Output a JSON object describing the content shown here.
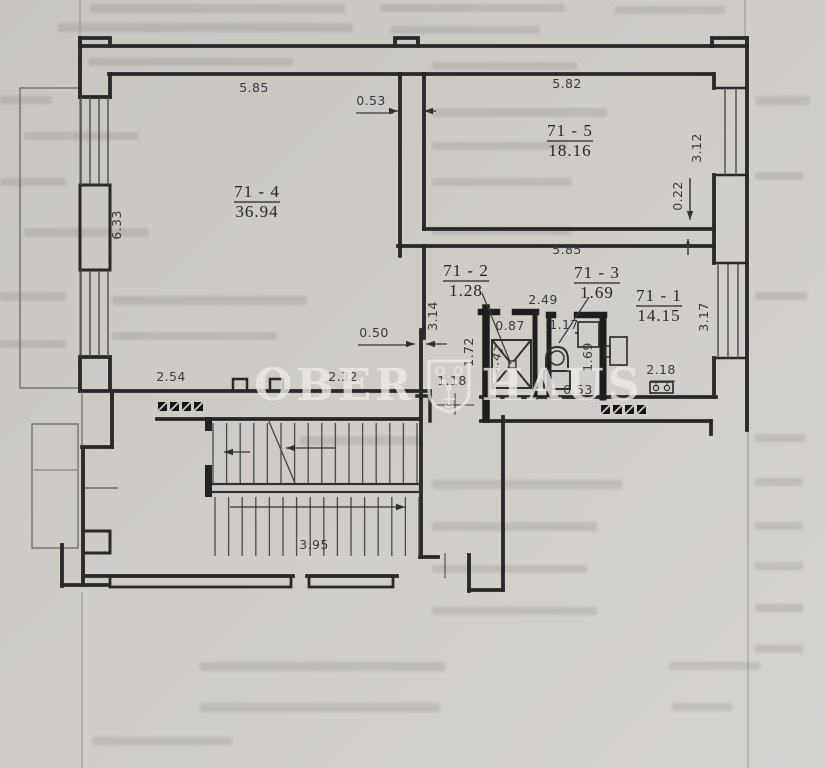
{
  "watermark": {
    "left": "OBER",
    "right": "HAUS"
  },
  "rooms": [
    {
      "id": "71 - 4",
      "area": "36.94",
      "x": 257,
      "y": 197
    },
    {
      "id": "71 - 5",
      "area": "18.16",
      "x": 570,
      "y": 136
    },
    {
      "id": "71 - 2",
      "area": "1.28",
      "x": 466,
      "y": 276
    },
    {
      "id": "71 - 3",
      "area": "1.69",
      "x": 597,
      "y": 278
    },
    {
      "id": "71 - 1",
      "area": "14.15",
      "x": 659,
      "y": 301
    }
  ],
  "dimensions": [
    {
      "text": "5.85",
      "x": 254,
      "y": 92,
      "rot": 0
    },
    {
      "text": "0.53",
      "x": 371,
      "y": 105,
      "rot": 0
    },
    {
      "text": "5.82",
      "x": 567,
      "y": 88,
      "rot": 0
    },
    {
      "text": "3.12",
      "x": 701,
      "y": 148,
      "rot": -90
    },
    {
      "text": "0.22",
      "x": 682,
      "y": 196,
      "rot": -90
    },
    {
      "text": "6.33",
      "x": 121,
      "y": 225,
      "rot": -90
    },
    {
      "text": "5.85",
      "x": 567,
      "y": 254,
      "rot": 0
    },
    {
      "text": "2.49",
      "x": 543,
      "y": 304,
      "rot": 0
    },
    {
      "text": "3.14",
      "x": 437,
      "y": 316,
      "rot": -90
    },
    {
      "text": "3.17",
      "x": 708,
      "y": 317,
      "rot": -90
    },
    {
      "text": "0.87",
      "x": 510,
      "y": 330,
      "rot": 0
    },
    {
      "text": "1.17",
      "x": 564,
      "y": 329,
      "rot": 0
    },
    {
      "text": "1.72",
      "x": 473,
      "y": 352,
      "rot": -90
    },
    {
      "text": "1.47",
      "x": 500,
      "y": 360,
      "rot": -72
    },
    {
      "text": "1.69",
      "x": 592,
      "y": 357,
      "rot": -90
    },
    {
      "text": "0.50",
      "x": 374,
      "y": 337,
      "rot": 0
    },
    {
      "text": "2.18",
      "x": 661,
      "y": 374,
      "rot": 0
    },
    {
      "text": "0.53",
      "x": 578,
      "y": 394,
      "rot": 0
    },
    {
      "text": "2.54",
      "x": 171,
      "y": 381,
      "rot": 0
    },
    {
      "text": "2.32",
      "x": 343,
      "y": 381,
      "rot": 0
    },
    {
      "text": "1.18",
      "x": 452,
      "y": 385,
      "rot": 0
    },
    {
      "text": "3.95",
      "x": 314,
      "y": 549,
      "rot": 0
    }
  ],
  "colors": {
    "paper": "#cdc9c5",
    "line": "#2a2826",
    "partition": "#201e1c",
    "dim_text": "#3a3a3a",
    "watermark": "#ece9e5"
  }
}
